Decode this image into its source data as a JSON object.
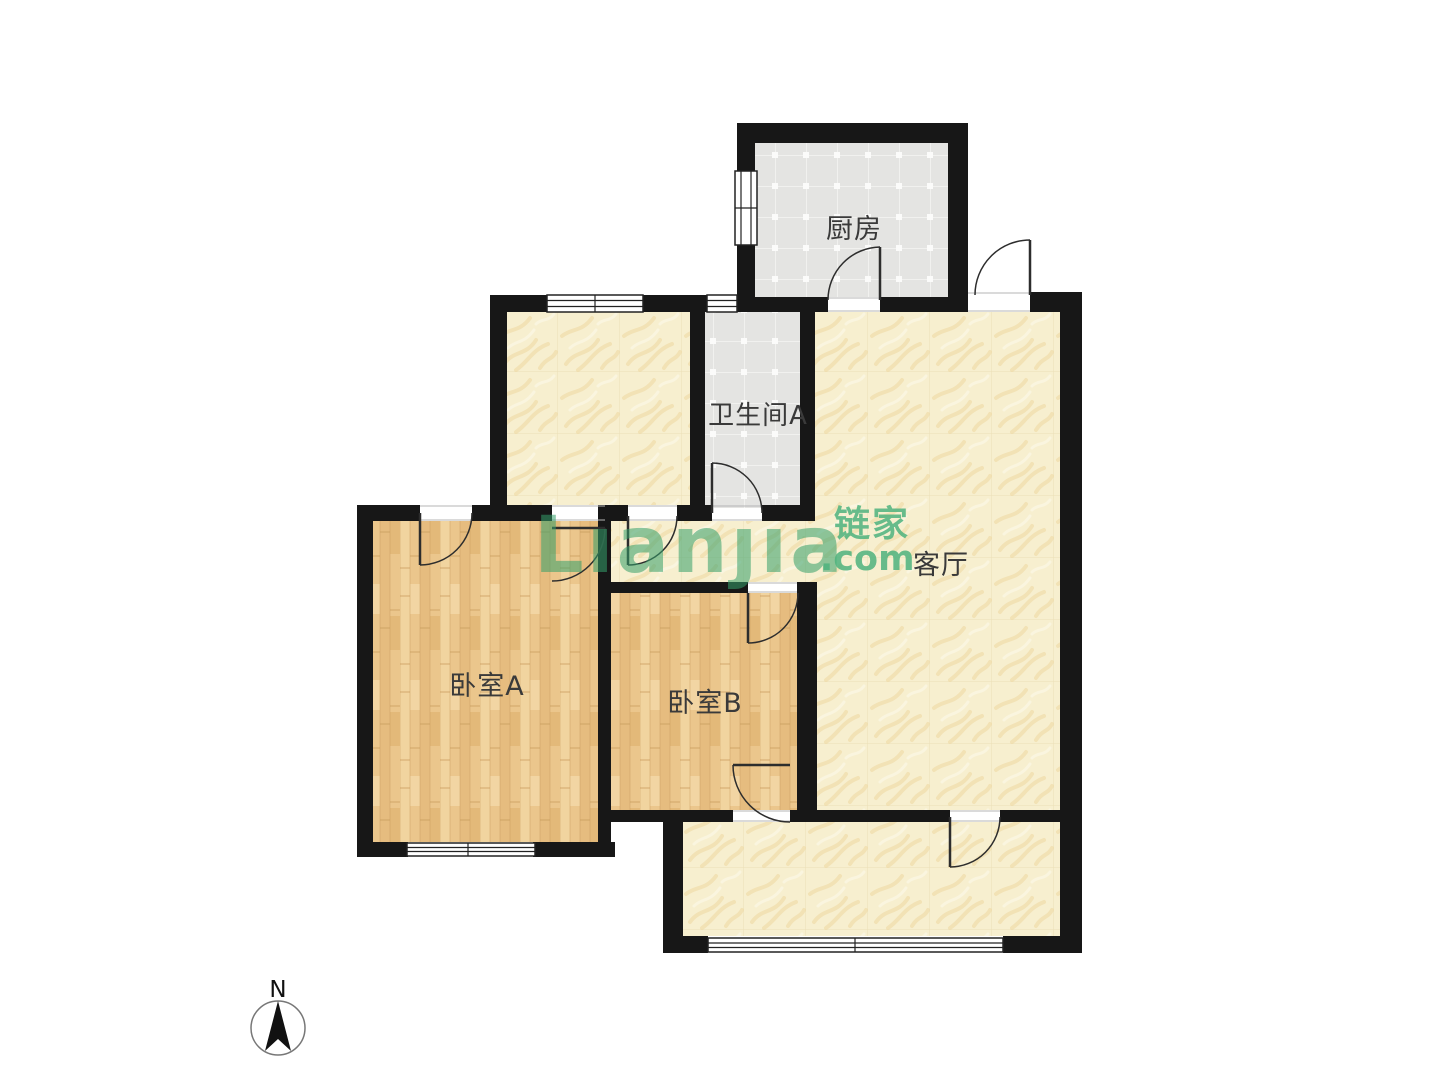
{
  "rooms": {
    "kitchen": {
      "label": "厨房"
    },
    "bathroom_a": {
      "label": "卫生间A"
    },
    "living_room": {
      "label": "客厅"
    },
    "bedroom_a": {
      "label": "卧室A"
    },
    "bedroom_b": {
      "label": "卧室B"
    }
  },
  "watermark": {
    "logo_latin": "Lıanȷıa",
    "logo_cn": "链家",
    "logo_tld": ".com",
    "logo_color": "#35a06b",
    "accent_color": "#4eb37e"
  },
  "compass": {
    "north_label": "N"
  },
  "colors": {
    "background": "#ffffff",
    "wall": "#171717",
    "door": "#2d2d2d",
    "threshold": "#b5b5b5",
    "label": "#3a3a3a",
    "tile_floor": "#e4e4e2",
    "cream_floor": "#f7efcf",
    "wood_floor": "#ebc68c"
  }
}
